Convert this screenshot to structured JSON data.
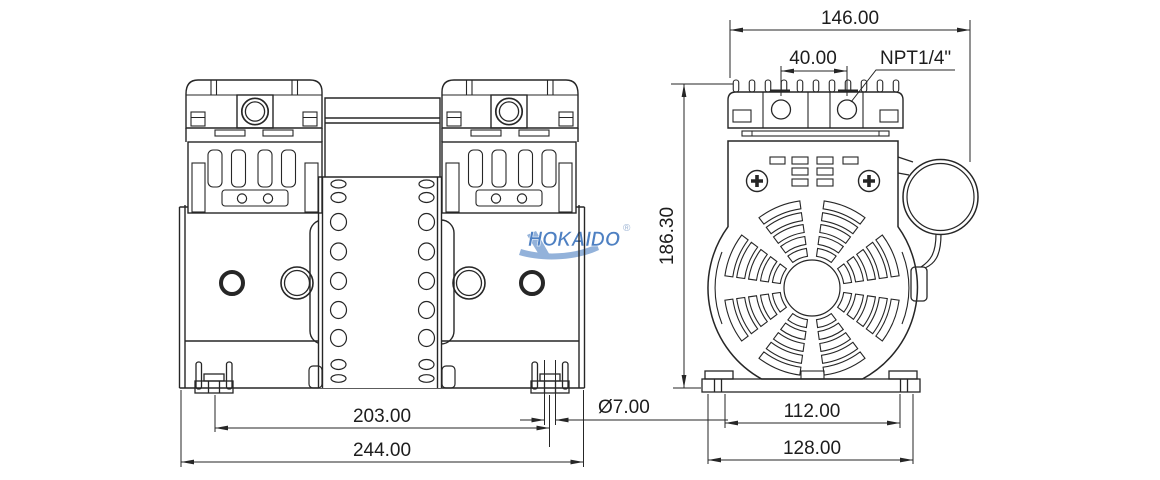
{
  "drawing": {
    "logo": {
      "text": "HOKAIDO",
      "registered": "®"
    },
    "front": {
      "dim_foot_center_spacing": "203.00",
      "dim_overall_width": "244.00",
      "dim_foot_slot_diameter": "Ø7.00"
    },
    "side": {
      "dim_overall_width": "146.00",
      "dim_port_spacing": "40.00",
      "port_thread_label": "NPT1/4\"",
      "dim_overall_height": "186.30",
      "dim_foot_spacing": "112.00",
      "dim_base_width": "128.00"
    },
    "colors": {
      "line": "#262626",
      "logo_blue": "#4e80c2",
      "logo_swoosh": "#93b2da"
    }
  }
}
